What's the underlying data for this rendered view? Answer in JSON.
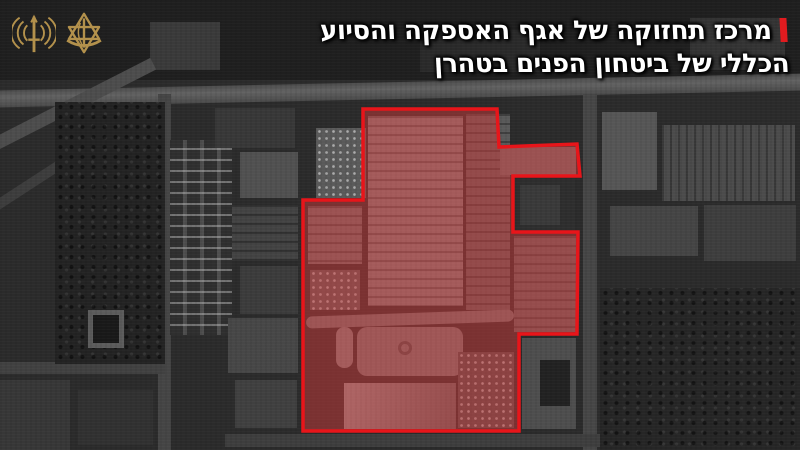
{
  "header": {
    "headline": {
      "line1": "מרכז תחזוקה של אגף האספקה והסיוע",
      "line2": "הכללי של ביטחון הפנים בטהרן"
    },
    "accent_color": "#e11b1f"
  },
  "logos": {
    "left": {
      "name": "radio-waves-unit-emblem",
      "color": "#b3914c"
    },
    "right": {
      "name": "idf-emblem",
      "color": "#b3914c"
    }
  },
  "overlay": {
    "label": "highlighted-compound",
    "polygon_points": "363,109 497,109 499,147 577,144 580,176 513,176 513,232 578,232 577,334 519,334 519,431 303,431 303,200 363,200",
    "fill_color": "rgba(214,60,60,0.47)",
    "stroke_color": "#e8151a",
    "stroke_width": "3.5"
  }
}
